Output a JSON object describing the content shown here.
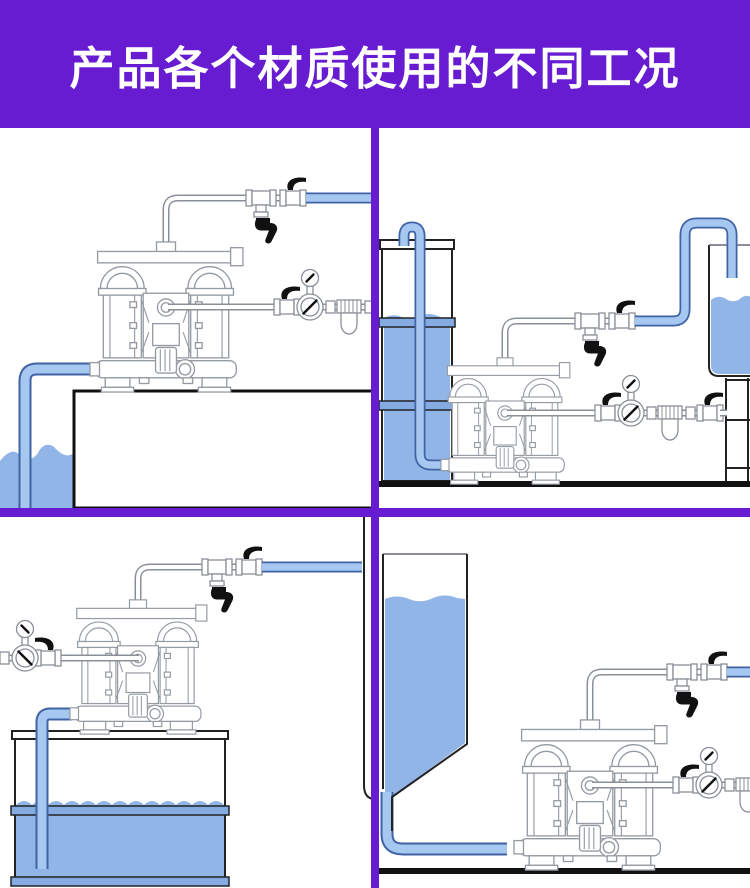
{
  "header": {
    "title": "产品各个材质使用的不同工况"
  },
  "colors": {
    "banner": "#671cd1",
    "panel_bg": "#ffffff",
    "water": "#92b5e8",
    "hose_fill": "#a5c7f0",
    "hose_border": "#3f63a5",
    "pipe_gray": "#8a9098",
    "pump_line": "#949ba3",
    "structure": "#222222",
    "ink": "#111111",
    "drum_band": "#84abe2"
  },
  "panels": [
    {
      "id": "top-left",
      "scene": "diaphragm pump on platform drawing liquid from pit below"
    },
    {
      "id": "top-right",
      "scene": "diaphragm pump on floor drawing from drum and discharging into elevated tank"
    },
    {
      "id": "bottom-left",
      "scene": "diaphragm pump mounted on drum drawing liquid directly from it"
    },
    {
      "id": "bottom-right",
      "scene": "diaphragm pump on floor gravity-fed from hopper"
    }
  ]
}
